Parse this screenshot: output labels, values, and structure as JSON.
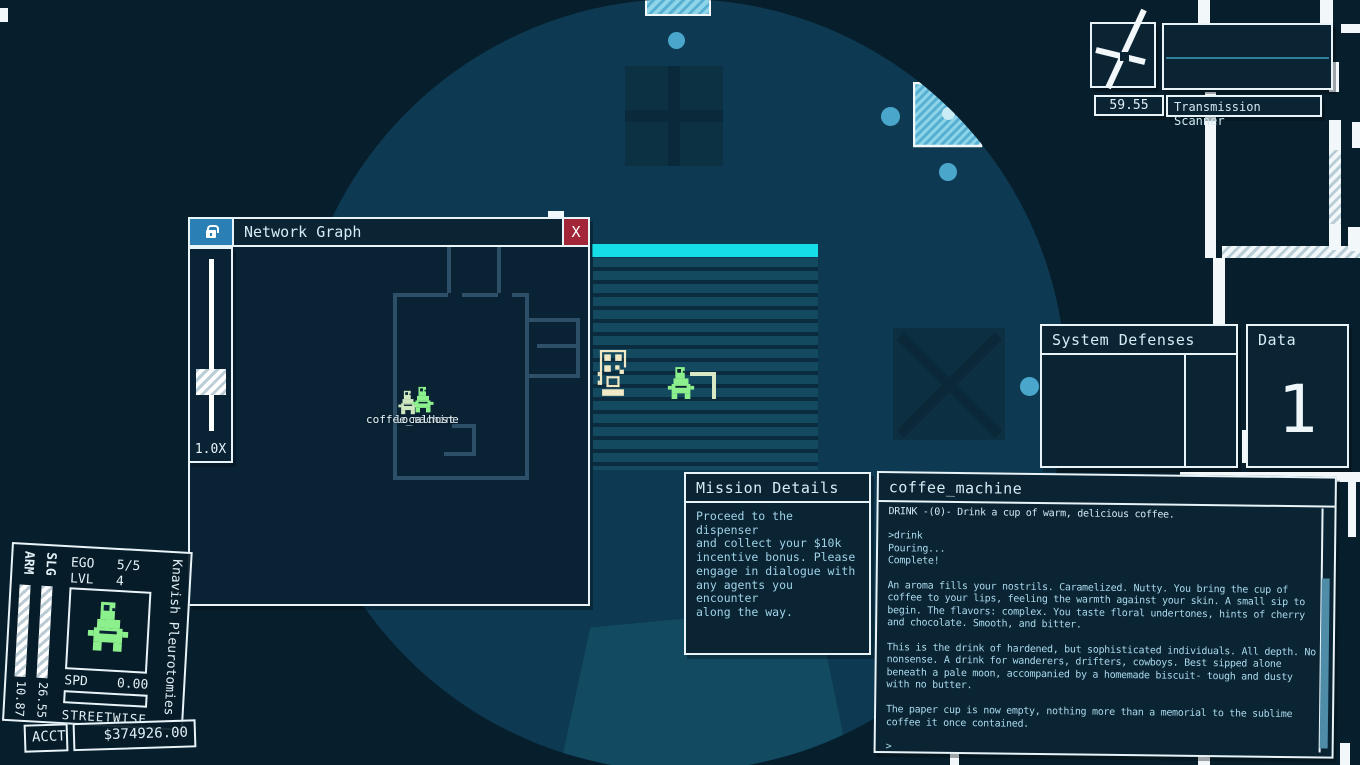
{
  "colors": {
    "bg": "#071f2c",
    "circle": "#0d3a52",
    "wall": "#f2f7fa",
    "border": "#e9f4f9",
    "winbg": "#0a2434",
    "accent": "#15dee9",
    "txt": "#a9d9ea",
    "title": "#d6ecf5",
    "green": "#8cf18c",
    "cream": "#efe9c6",
    "red": "#a32638",
    "lockblue": "#2a7fb5",
    "slate": "#2d5068"
  },
  "clock": {
    "value": "59.55"
  },
  "scanner": {
    "title": "Transmission Scanner"
  },
  "network_graph": {
    "title": "Network Graph",
    "close_label": "X",
    "zoom_label": "1.0X",
    "node_label_machine": "coffee_machine",
    "node_label_host": "localhost"
  },
  "system_defenses": {
    "title": "System Defenses"
  },
  "data_window": {
    "title": "Data",
    "value": "1"
  },
  "mission": {
    "title": "Mission Details",
    "body": "Proceed to the dispenser\nand collect your $10k\nincentive bonus. Please\nengage in dialogue with\nany agents you encounter\nalong the way."
  },
  "terminal": {
    "title": "coffee_machine",
    "usage": "DRINK -(0)- Drink a cup of warm, delicious coffee.",
    "log": ">drink\nPouring...\nComplete!\n\nAn aroma fills your nostrils. Caramelized. Nutty. You bring the cup of\ncoffee to your lips, feeling the warmth against your skin. A small sip to\nbegin. The flavors: complex. You taste floral undertones, hints of cherry\nand chocolate. Smooth, and bitter.\n\nThis is the drink of hardened, but sophisticated individuals. All depth. No\nnonsense. A drink for wanderers, drifters, cowboys. Best sipped alone\nbeneath a pale moon, accompanied by a homemade biscuit- tough and dusty\nwith no butter.\n\nThe paper cup is now empty, nothing more than a memorial to the sublime\ncoffee it once contained.\n\n>"
  },
  "character": {
    "name": "Knavish Pleurotomies",
    "arm_label": "ARM",
    "arm_value": "10.87",
    "slg_label": "SLG",
    "slg_value": "26.55",
    "ego_label": "EGO",
    "ego_value": "5/5",
    "lvl_label": "LVL",
    "lvl_value": "4",
    "spd_label": "SPD",
    "spd_value": "0.00",
    "class_label": "STREETWISE",
    "acct_label": "ACCT",
    "acct_value": "$374926.00"
  },
  "icons": {
    "lock": "padlock",
    "close": "X",
    "clock": "analog-clock"
  }
}
